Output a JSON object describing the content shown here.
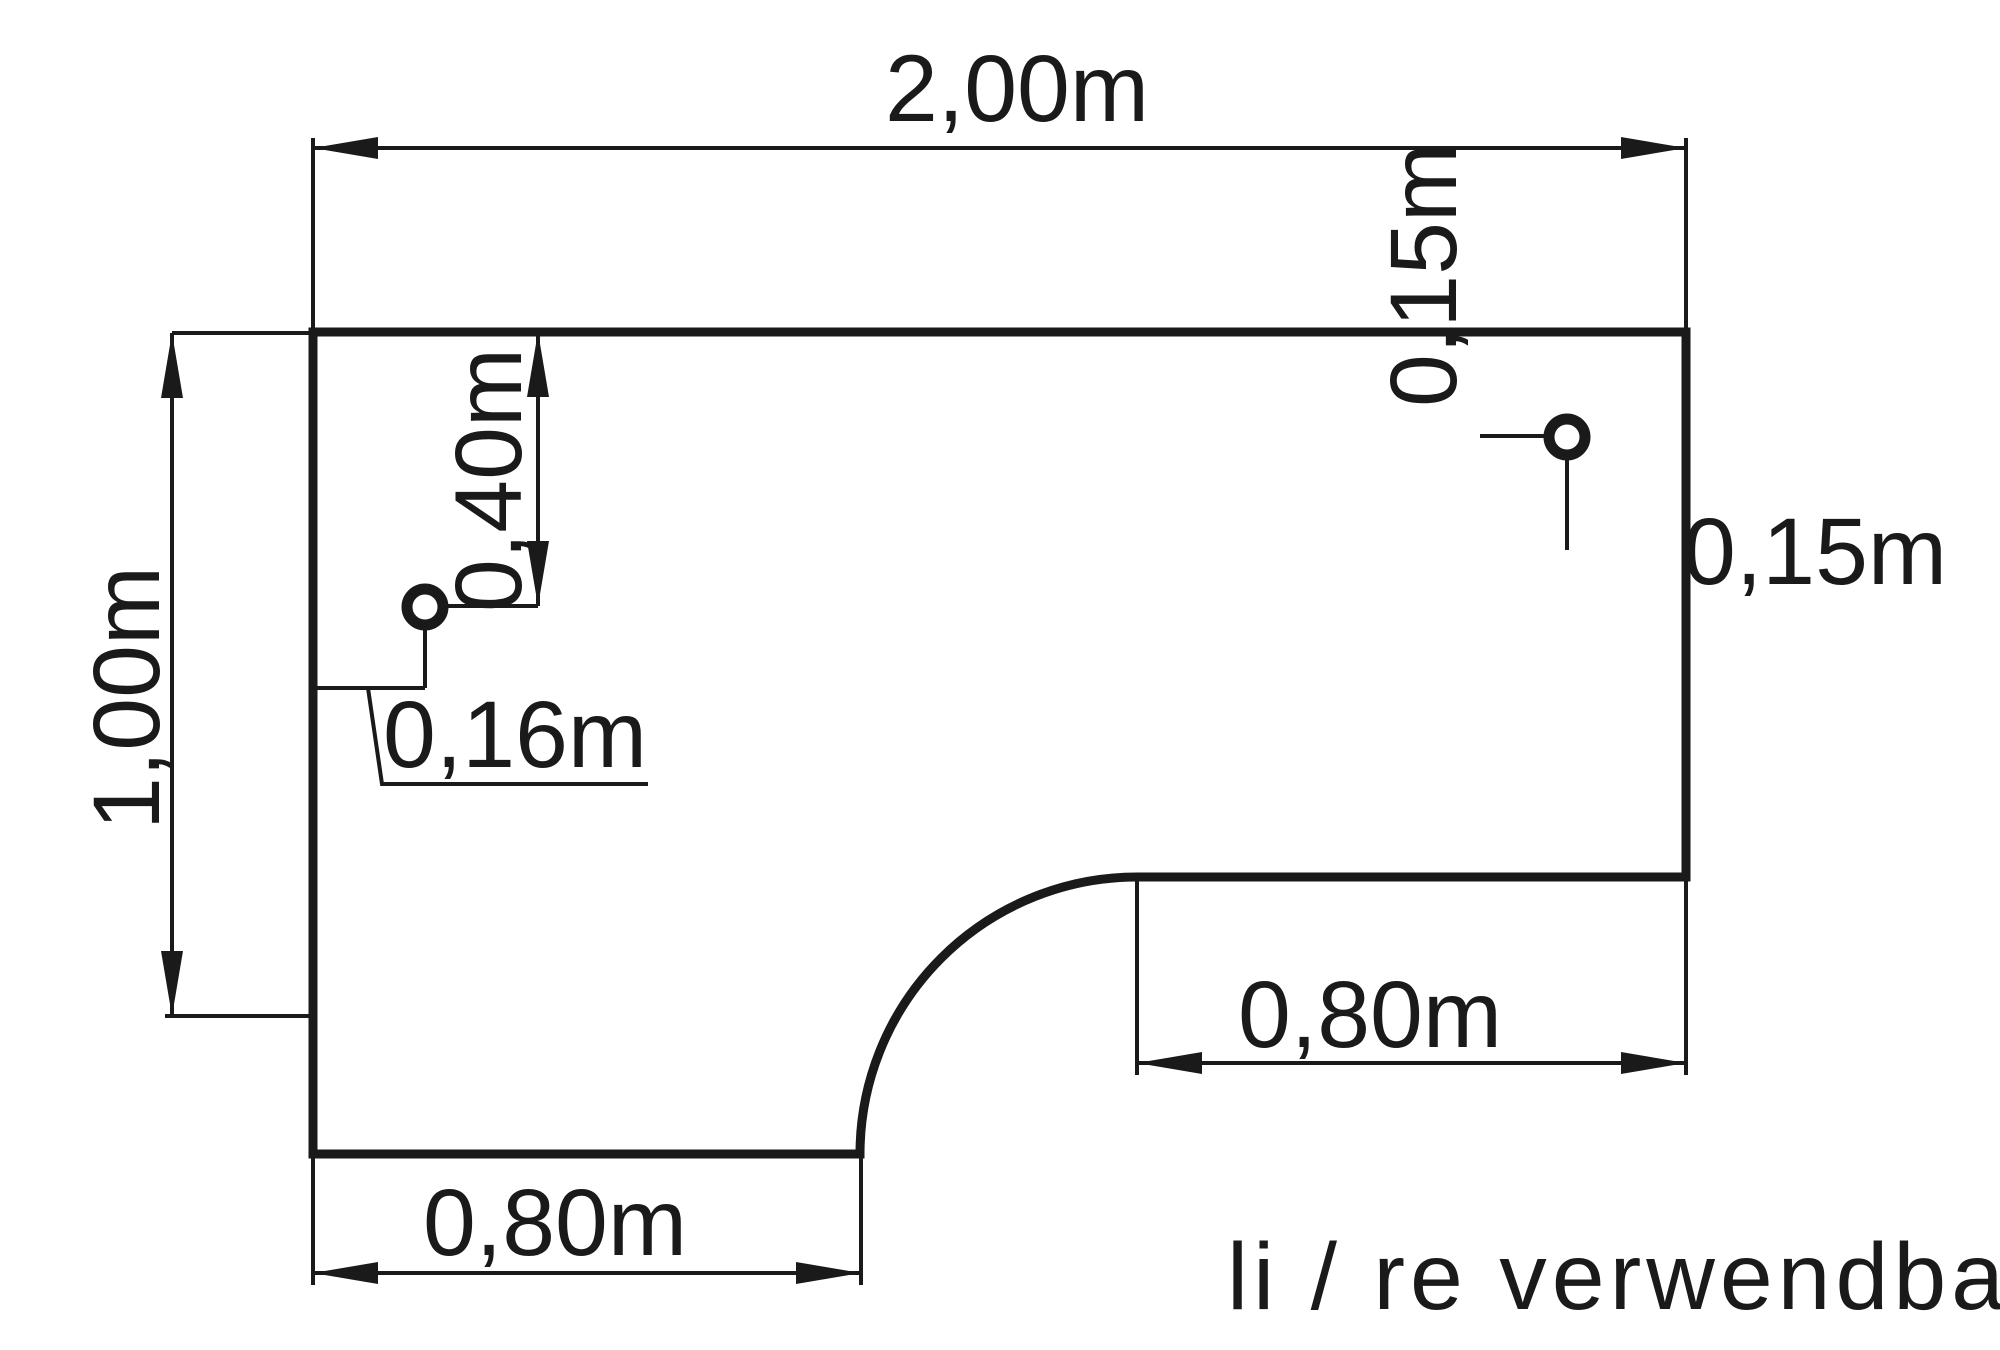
{
  "colors": {
    "line": "#1a1a1a",
    "background": "#ffffff"
  },
  "drawing": {
    "note": "li / re verwendbar",
    "dimensions": {
      "top_width": "2,00m",
      "left_depth": "1,00m",
      "left_hole_from_top": "0,40m",
      "left_hole_from_left_edge": "0,16m",
      "right_hole_from_top": "0,15m",
      "right_hole_from_right_edge": "0,15m",
      "right_return_width": "0,80m",
      "bottom_return_width": "0,80m"
    }
  }
}
